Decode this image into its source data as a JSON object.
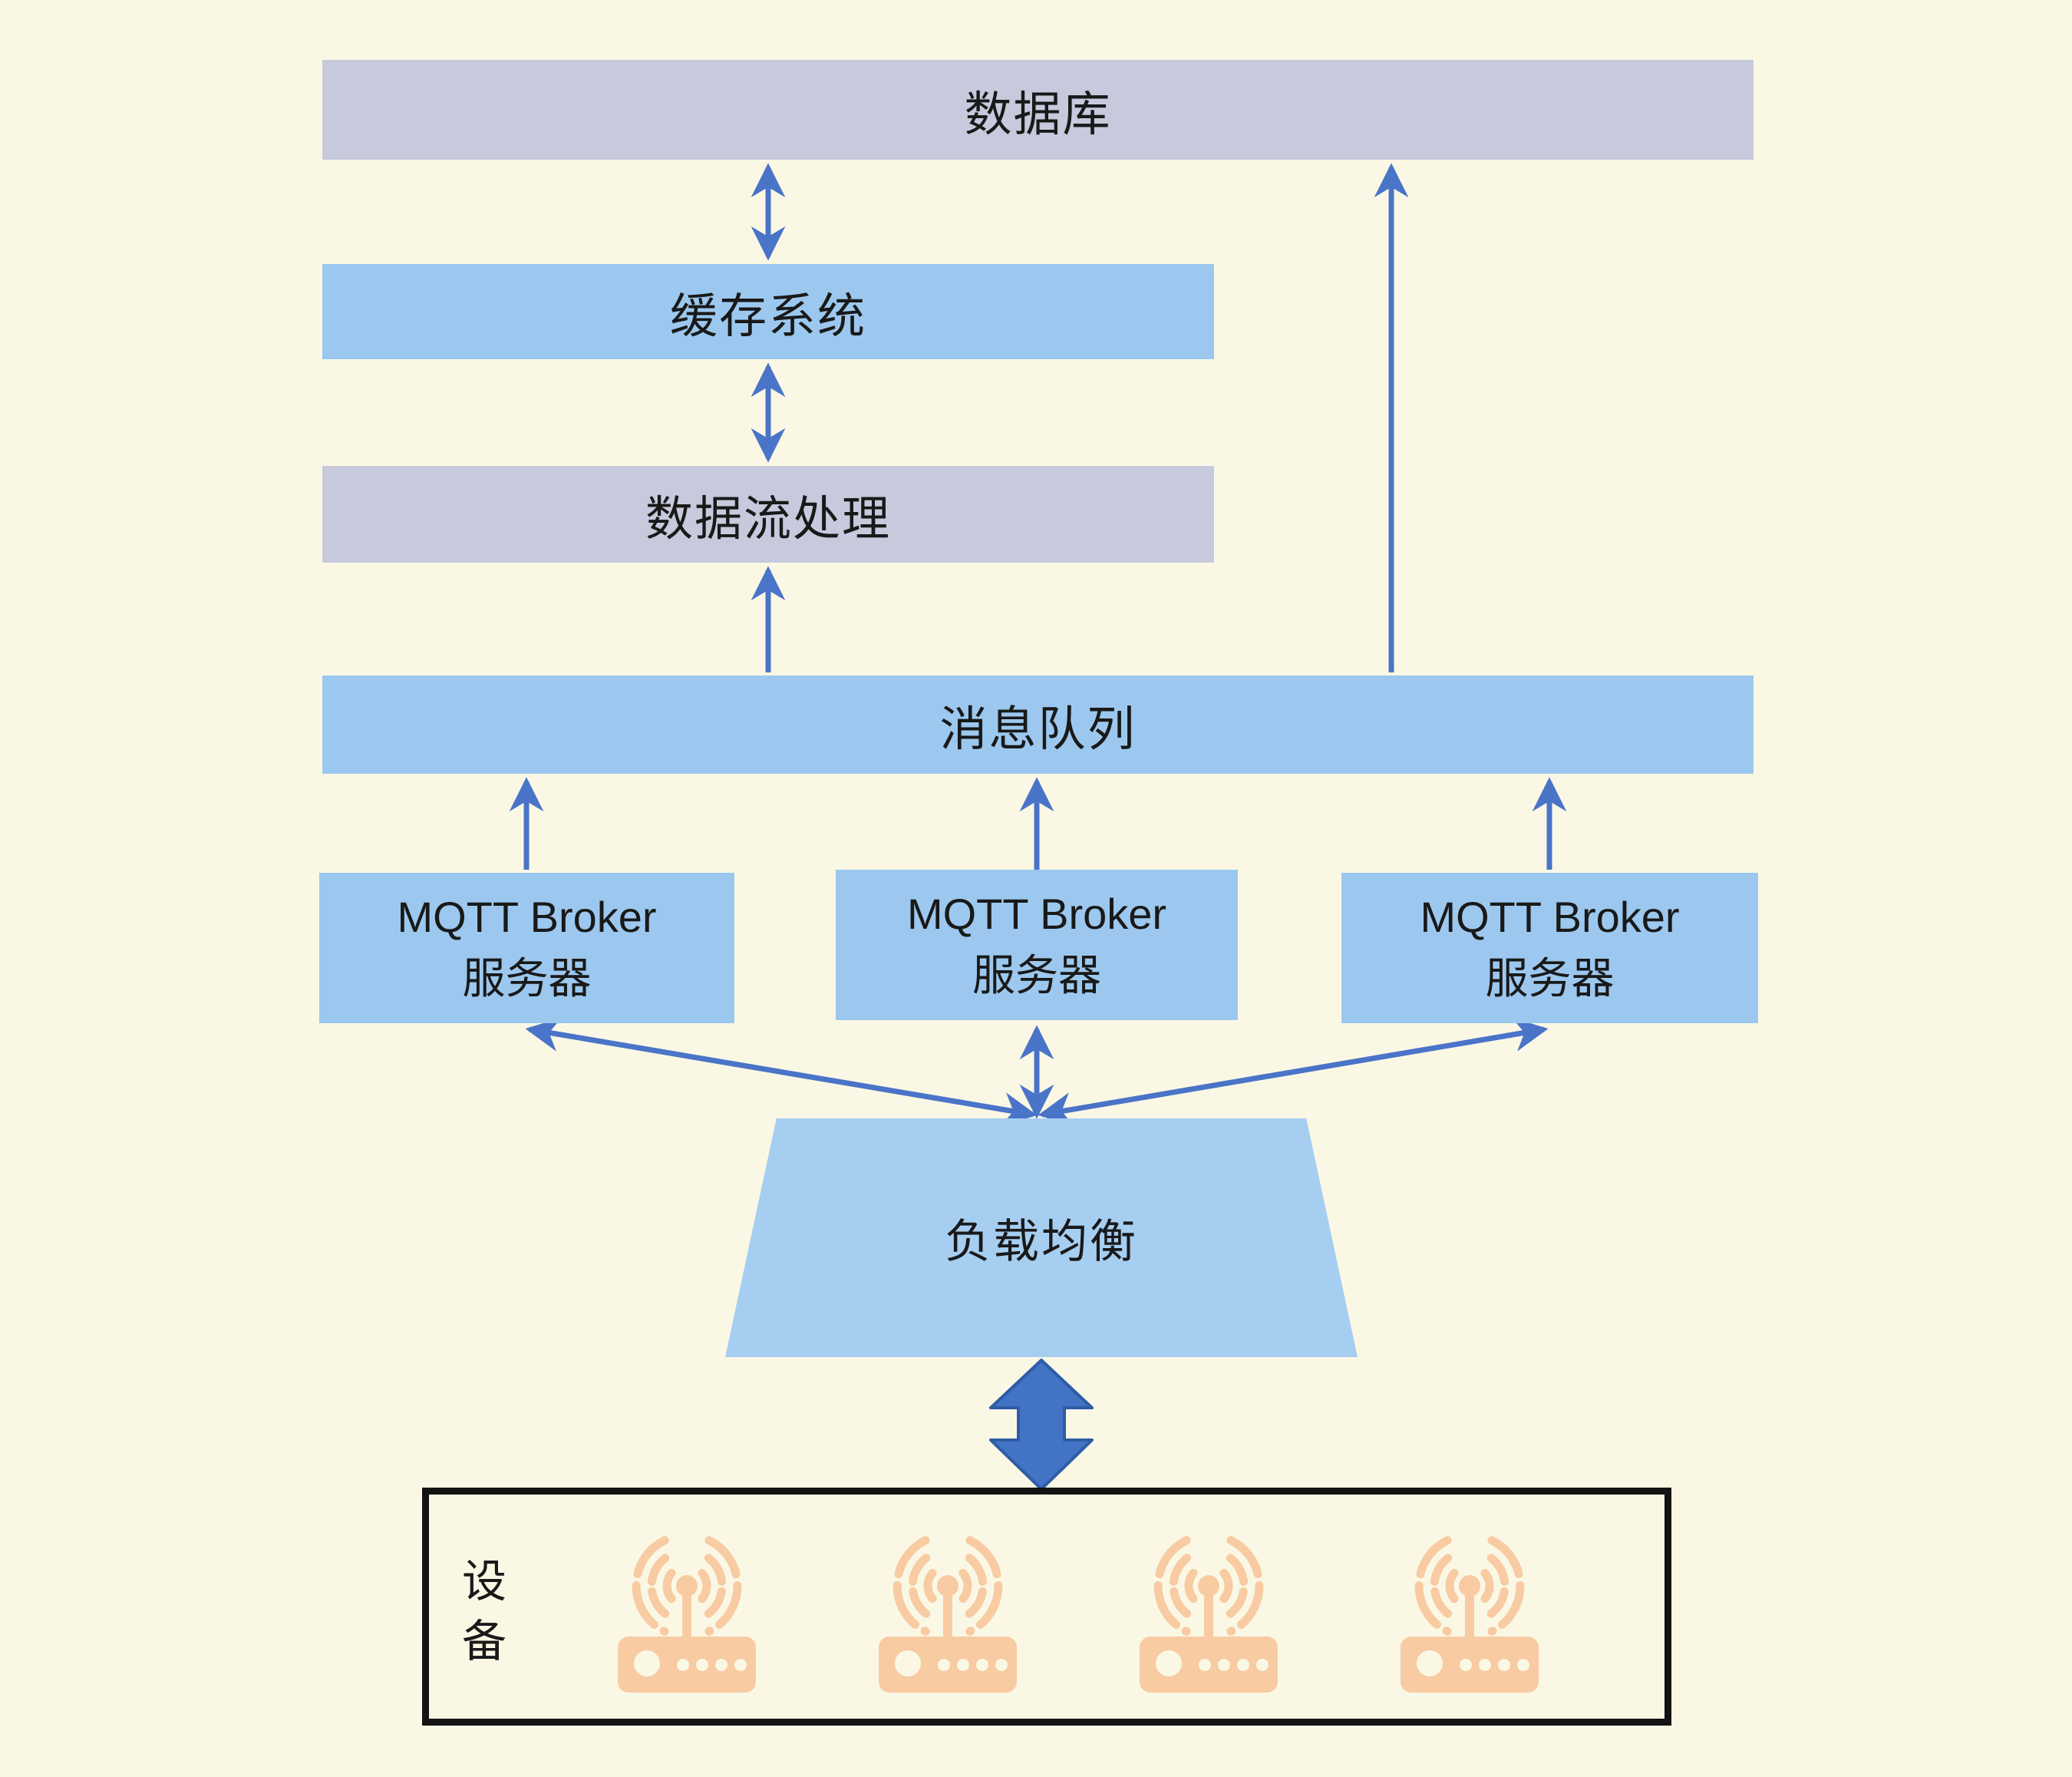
{
  "diagram": {
    "type": "architecture-flow",
    "layers": {
      "database": {
        "label": "数据库"
      },
      "cache": {
        "label": "缓存系统"
      },
      "stream_processing": {
        "label": "数据流处理"
      },
      "message_queue": {
        "label": "消息队列"
      }
    },
    "brokers": [
      {
        "line1": "MQTT Broker",
        "line2": "服务器"
      },
      {
        "line1": "MQTT Broker",
        "line2": "服务器"
      },
      {
        "line1": "MQTT Broker",
        "line2": "服务器"
      }
    ],
    "load_balancer": {
      "label": "负载均衡"
    },
    "devices": {
      "label": "设备",
      "count": 4,
      "icon": "wifi-router-icon"
    },
    "edges": [
      {
        "from": "数据库",
        "to": "缓存系统",
        "bidirectional": true
      },
      {
        "from": "缓存系统",
        "to": "数据流处理",
        "bidirectional": true
      },
      {
        "from": "消息队列",
        "to": "数据流处理",
        "bidirectional": false
      },
      {
        "from": "消息队列",
        "to": "数据库",
        "bidirectional": false
      },
      {
        "from": "MQTT Broker 服务器 (左)",
        "to": "消息队列",
        "bidirectional": false
      },
      {
        "from": "MQTT Broker 服务器 (中)",
        "to": "消息队列",
        "bidirectional": false
      },
      {
        "from": "MQTT Broker 服务器 (右)",
        "to": "消息队列",
        "bidirectional": false
      },
      {
        "from": "负载均衡",
        "to": "MQTT Broker 服务器 (左)",
        "bidirectional": true
      },
      {
        "from": "负载均衡",
        "to": "MQTT Broker 服务器 (中)",
        "bidirectional": true
      },
      {
        "from": "负载均衡",
        "to": "MQTT Broker 服务器 (右)",
        "bidirectional": true
      },
      {
        "from": "负载均衡",
        "to": "设备",
        "bidirectional": true,
        "style": "thick-block-arrow"
      }
    ],
    "colors": {
      "background": "#FAF8E5",
      "lavender_box": "#C7CADD",
      "blue_box": "#9CC8EF",
      "trapezoid_box": "#A6CEF1",
      "arrow": "#4A74C8",
      "block_arrow": "#4273C5",
      "device_icon": "#F8CBA2",
      "device_border": "#131313",
      "text": "#191919"
    }
  }
}
